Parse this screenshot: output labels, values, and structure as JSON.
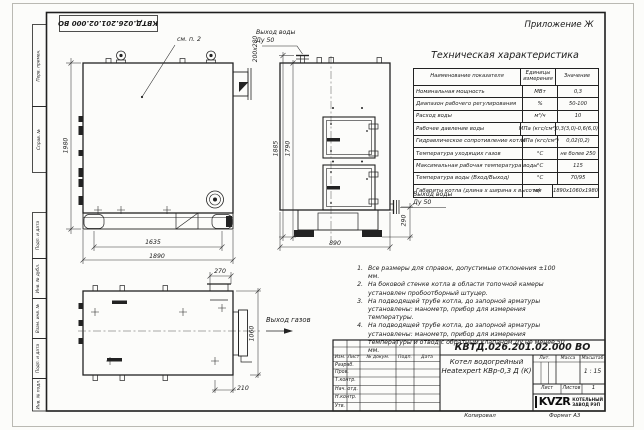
{
  "sheet": {
    "appendix": "Приложение Ж",
    "top_doc_number": "КВТД.026.201.02.000 ВО",
    "margin_stamps": [
      "Перв. примен.",
      "Справ. №",
      "Подп. и дата",
      "Инв. № дубл.",
      "Взам. инв. №",
      "Подп. и дата",
      "Инв. № подл."
    ],
    "footer": {
      "copied": "Копировал",
      "format": "Формат А3"
    }
  },
  "drawing": {
    "callouts": {
      "see_note": "см. п. 2",
      "water_outlet_line1": "Выход воды",
      "water_outlet_line2": "Ду 50",
      "gas_outlet": "Выход газов",
      "chimney_section": "200х280"
    },
    "dims": {
      "front_height": "1980",
      "front_feet_span": "1635",
      "front_length": "1890",
      "side_height_total": "1885",
      "side_height_flange": "1790",
      "side_width": "890",
      "side_pipe_height": "290",
      "plan_chimney_width": "270",
      "plan_depth": "1060",
      "plan_chimney_offset": "210"
    }
  },
  "spec_table": {
    "title": "Техническая характеристика",
    "col_name": "Наименование показателя",
    "col_units": "Единицы измерения",
    "col_value": "Значение",
    "rows": [
      {
        "name": "Номинальная мощность",
        "unit": "МВт",
        "value": "0,3"
      },
      {
        "name": "Диапазон рабочего регулирования",
        "unit": "%",
        "value": "50-100"
      },
      {
        "name": "Расход воды",
        "unit": "м³/ч",
        "value": "10"
      },
      {
        "name": "Рабочее давление воды",
        "unit": "МПа (кгс/см²)",
        "value": "0,3(3,0)-0,6(6,0)"
      },
      {
        "name": "Гидравлическое сопротивление котла",
        "unit": "МПа (кгс/см²)",
        "value": "0,02(0,2)"
      },
      {
        "name": "Температура уходящих газов",
        "unit": "°С",
        "value": "не более 250"
      },
      {
        "name": "Максимальная рабочая температура воды",
        "unit": "°С",
        "value": "115"
      },
      {
        "name": "Температура воды (Вход/Выход)",
        "unit": "°С",
        "value": "70/95"
      },
      {
        "name": "Габариты котла (длина х ширина х высота)",
        "unit": "мм",
        "value": "1890х1060х1980"
      }
    ]
  },
  "notes": {
    "items": [
      {
        "num": "1.",
        "text": "Все размеры для справок, допустимые отклонения ±100 мм."
      },
      {
        "num": "2.",
        "text": "На боковой стенке котла в области топочной камеры установлен пробоотборный штуцер."
      },
      {
        "num": "3.",
        "text": "На подводящей трубе котла, до запорной арматуры установлены: манометр, прибор для измерения температуры."
      },
      {
        "num": "4.",
        "text": "На подводящей трубе котла, до запорной арматуры установлены: манометр, прибор для измерения температуры и отвод с обратным клапаном Ду не менее 50 мм."
      }
    ]
  },
  "title_block": {
    "doc_number": "КВТД.026.201.02.000 ВО",
    "product_line1": "Котел водогрейный",
    "product_line2": "Heatexpert КВр-0,3 Д (К)",
    "col_izm": "Изм.",
    "col_list": "Лист",
    "col_doc": "№ докум.",
    "col_sign": "Подп.",
    "col_date": "Дата",
    "sig_rows": [
      "Разраб.",
      "Пров.",
      "Т.контр.",
      "Нач. отд.",
      "Н.контр.",
      "Утв."
    ],
    "lit_label": "Лит.",
    "mass_label": "Масса",
    "scale_label": "Масштаб",
    "scale_value": "1 : 15",
    "sheet_label": "Лист",
    "sheets_label": "Листов",
    "sheets_value": "1",
    "logo_text": "KVZR",
    "company_line1": "КОТЕЛЬНЫЙ",
    "company_line2": "ЗАВОД РЭП"
  }
}
